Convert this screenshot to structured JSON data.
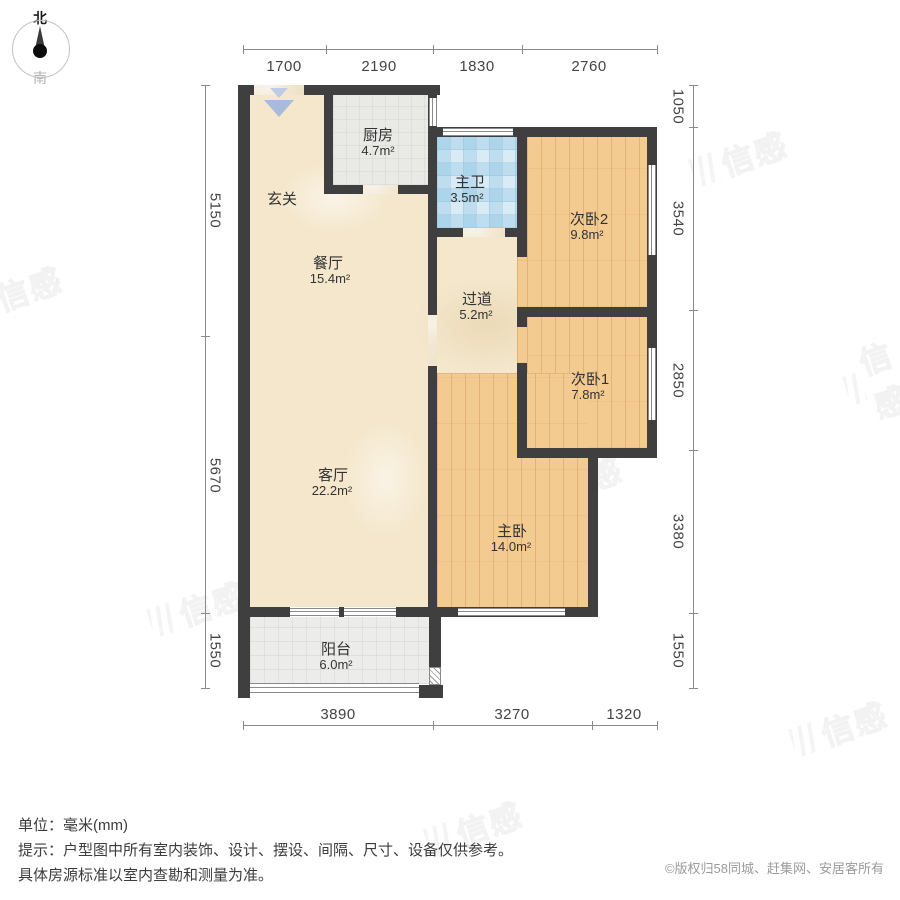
{
  "compass": {
    "north": "北",
    "south": "南"
  },
  "rooms": {
    "xuanguan": {
      "name": "玄关",
      "area": ""
    },
    "chufang": {
      "name": "厨房",
      "area": "4.7m²"
    },
    "zhuwei": {
      "name": "主卫",
      "area": "3.5m²"
    },
    "ciwo2": {
      "name": "次卧2",
      "area": "9.8m²"
    },
    "canting": {
      "name": "餐厅",
      "area": "15.4m²"
    },
    "guodao": {
      "name": "过道",
      "area": "5.2m²"
    },
    "ciwo1": {
      "name": "次卧1",
      "area": "7.8m²"
    },
    "keting": {
      "name": "客厅",
      "area": "22.2m²"
    },
    "zhuwo": {
      "name": "主卧",
      "area": "14.0m²"
    },
    "yangtai": {
      "name": "阳台",
      "area": "6.0m²"
    }
  },
  "dimensions": {
    "top": [
      "1700",
      "2190",
      "1830",
      "2760"
    ],
    "bottom": [
      "3890",
      "3270",
      "1320"
    ],
    "left": [
      "5150",
      "5670",
      "1550"
    ],
    "right": [
      "1050",
      "3540",
      "2850",
      "3380",
      "1550"
    ]
  },
  "footer": {
    "unit_label": "单位：毫米(mm)",
    "tip_line1": "提示：户型图中所有室内装饰、设计、摆设、间隔、尺寸、设备仅供参考。",
    "tip_line2": "具体房源标准以室内查勘和测量为准。",
    "copyright": "©版权归58同城、赶集网、安居客所有"
  },
  "watermark": {
    "glyphs": "信感"
  },
  "colors": {
    "wall": "#3f3f3f",
    "wood_floor": "#f3ca90",
    "marble_floor": "#f4e7cc",
    "kitchen_tile": "#e9e9e6",
    "bath_tile": "#d9ebf5",
    "balcony_tile": "#ececea",
    "dimension_text": "#444444",
    "copyright_text": "#9b9b9b",
    "entrance_arrow": "#a9bbdc"
  }
}
